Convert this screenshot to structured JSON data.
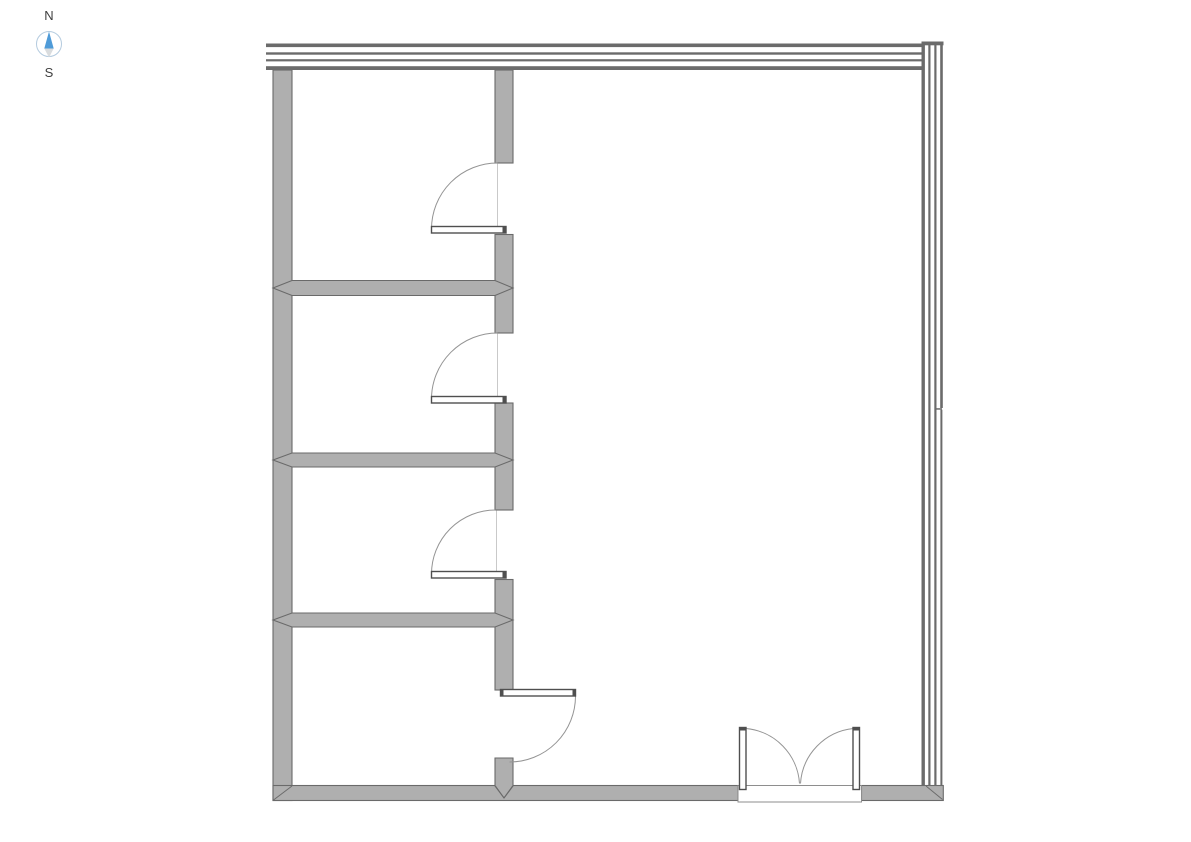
{
  "compass": {
    "north_label": "N",
    "south_label": "S",
    "ring_color": "#b4cbdf",
    "north_needle_color": "#4f9bd8",
    "south_needle_color": "#d9dcde",
    "label_color": "#3f3f3f"
  },
  "colors": {
    "background": "#ffffff",
    "wall_fill": "#afafaf",
    "wall_outline": "#6a6a6a",
    "curtain_line": "#6b6b6b",
    "door_swing": "#949494",
    "door_leaf_outline": "#4f4f4f"
  },
  "plan": {
    "canvas_width": 1191,
    "canvas_height": 842,
    "elements": [
      {
        "kind": "rect",
        "name": "left-exterior-wall",
        "cls": "wall",
        "interactable": true,
        "attrs": {
          "x": 273,
          "y": 70,
          "width": 19,
          "height": 730.5
        }
      },
      {
        "kind": "rect",
        "name": "south-wall-west-segment",
        "cls": "wall",
        "interactable": true,
        "attrs": {
          "x": 273,
          "y": 785.5,
          "width": 465,
          "height": 15
        }
      },
      {
        "kind": "rect",
        "name": "south-wall-east-segment",
        "cls": "wall",
        "interactable": true,
        "attrs": {
          "x": 861.5,
          "y": 785.5,
          "width": 81.8,
          "height": 15
        }
      },
      {
        "kind": "rect",
        "name": "interior-wall-segment-1",
        "cls": "wall",
        "interactable": true,
        "attrs": {
          "x": 495,
          "y": 70,
          "width": 18,
          "height": 93
        }
      },
      {
        "kind": "rect",
        "name": "interior-wall-segment-2",
        "cls": "wall",
        "interactable": true,
        "attrs": {
          "x": 495,
          "y": 234.5,
          "width": 18,
          "height": 98.5
        }
      },
      {
        "kind": "rect",
        "name": "interior-wall-segment-3",
        "cls": "wall",
        "interactable": true,
        "attrs": {
          "x": 495,
          "y": 403,
          "width": 18,
          "height": 107
        }
      },
      {
        "kind": "rect",
        "name": "interior-wall-segment-4",
        "cls": "wall",
        "interactable": true,
        "attrs": {
          "x": 495,
          "y": 579.5,
          "width": 18,
          "height": 110.5
        }
      },
      {
        "kind": "polygon",
        "name": "interior-wall-segment-5",
        "cls": "wall",
        "interactable": true,
        "attrs": {
          "points": "495,758 513,758 513,786 504,798 495,786"
        }
      },
      {
        "kind": "polygon",
        "name": "partition-wall-1",
        "cls": "wall",
        "interactable": true,
        "attrs": {
          "points": "273,288 292,280.5 495,280.5 513,288 495,295.5 292,295.5"
        }
      },
      {
        "kind": "polygon",
        "name": "partition-wall-2",
        "cls": "wall",
        "interactable": true,
        "attrs": {
          "points": "273,460 292,453 495,453 513,460 495,467 292,467"
        }
      },
      {
        "kind": "polygon",
        "name": "partition-wall-3",
        "cls": "wall",
        "interactable": true,
        "attrs": {
          "points": "273,620 292,613 495,613 513,620 495,627 292,627"
        }
      },
      {
        "kind": "line",
        "name": "southwest-corner-miter-seam",
        "cls": "seam",
        "interactable": false,
        "attrs": {
          "x1": 273.5,
          "y1": 800,
          "x2": 292,
          "y2": 786
        }
      },
      {
        "kind": "line",
        "name": "interior-wall-south-miter-seam-left",
        "cls": "seam",
        "interactable": false,
        "attrs": {
          "x1": 495.5,
          "y1": 786,
          "x2": 504,
          "y2": 798
        }
      },
      {
        "kind": "line",
        "name": "interior-wall-south-miter-seam-right",
        "cls": "seam",
        "interactable": false,
        "attrs": {
          "x1": 504,
          "y1": 798,
          "x2": 512.5,
          "y2": 786
        }
      },
      {
        "kind": "line",
        "name": "southeast-corner-miter-seam",
        "cls": "seam",
        "interactable": false,
        "attrs": {
          "x1": 926,
          "y1": 786,
          "x2": 942.5,
          "y2": 799.5
        }
      },
      {
        "kind": "rect",
        "name": "north-curtain-wall-line-1",
        "cls": "cline",
        "interactable": true,
        "attrs": {
          "x": 266,
          "y": 43.5,
          "width": 656,
          "height": 3.6
        }
      },
      {
        "kind": "rect",
        "name": "north-curtain-wall-line-2",
        "cls": "cline",
        "interactable": true,
        "attrs": {
          "x": 266,
          "y": 52.3,
          "width": 656,
          "height": 2.4
        }
      },
      {
        "kind": "rect",
        "name": "north-curtain-wall-line-3",
        "cls": "cline",
        "interactable": true,
        "attrs": {
          "x": 266,
          "y": 59.2,
          "width": 656,
          "height": 2.2
        }
      },
      {
        "kind": "rect",
        "name": "north-curtain-wall-line-4",
        "cls": "cline",
        "interactable": true,
        "attrs": {
          "x": 266,
          "y": 66.2,
          "width": 656,
          "height": 3.8
        }
      },
      {
        "kind": "rect",
        "name": "east-curtain-wall-top-cap",
        "cls": "cline",
        "interactable": true,
        "attrs": {
          "x": 921.5,
          "y": 41.5,
          "width": 22,
          "height": 3.8
        }
      },
      {
        "kind": "rect",
        "name": "east-curtain-wall-line-1",
        "cls": "cline",
        "interactable": true,
        "attrs": {
          "x": 921.5,
          "y": 41.5,
          "width": 3.4,
          "height": 744
        }
      },
      {
        "kind": "rect",
        "name": "east-curtain-wall-line-2",
        "cls": "cline",
        "interactable": true,
        "attrs": {
          "x": 928.3,
          "y": 45,
          "width": 2.2,
          "height": 740.5
        }
      },
      {
        "kind": "rect",
        "name": "east-curtain-wall-line-3",
        "cls": "cline",
        "interactable": true,
        "attrs": {
          "x": 934.3,
          "y": 45,
          "width": 2.2,
          "height": 740.5
        }
      },
      {
        "kind": "rect",
        "name": "east-curtain-wall-line-4-upper",
        "cls": "cline",
        "interactable": true,
        "attrs": {
          "x": 940.2,
          "y": 45,
          "width": 2.6,
          "height": 363
        }
      },
      {
        "kind": "rect",
        "name": "east-curtain-wall-panel-break",
        "cls": "cline",
        "interactable": false,
        "attrs": {
          "x": 936,
          "y": 408.2,
          "width": 6,
          "height": 1.5
        }
      },
      {
        "kind": "rect",
        "name": "east-curtain-wall-line-4-lower",
        "cls": "cline",
        "interactable": true,
        "attrs": {
          "x": 940.4,
          "y": 409.7,
          "width": 2,
          "height": 375.8
        }
      },
      {
        "kind": "line",
        "name": "door-1-frame-line",
        "cls": "frame",
        "interactable": false,
        "attrs": {
          "x1": 497.5,
          "y1": 163.5,
          "x2": 497.5,
          "y2": 226
        }
      },
      {
        "kind": "path",
        "name": "door-1-swing-arc",
        "cls": "arc",
        "interactable": true,
        "attrs": {
          "d": "M431.5,229 A66,66 0 0 1 497.5,163"
        }
      },
      {
        "kind": "rect",
        "name": "door-1-leaf",
        "cls": "leaf",
        "interactable": true,
        "attrs": {
          "x": 431.5,
          "y": 226.5,
          "width": 74.5,
          "height": 6.5
        }
      },
      {
        "kind": "rect",
        "name": "door-1-hinge-cap",
        "cls": "cap",
        "interactable": false,
        "attrs": {
          "x": 502.5,
          "y": 226.5,
          "width": 3.5,
          "height": 6.5
        }
      },
      {
        "kind": "line",
        "name": "door-2-frame-line",
        "cls": "frame",
        "interactable": false,
        "attrs": {
          "x1": 497.5,
          "y1": 333.5,
          "x2": 497.5,
          "y2": 396
        }
      },
      {
        "kind": "path",
        "name": "door-2-swing-arc",
        "cls": "arc",
        "interactable": true,
        "attrs": {
          "d": "M431.5,399 A66,66 0 0 1 497.5,333"
        }
      },
      {
        "kind": "rect",
        "name": "door-2-leaf",
        "cls": "leaf",
        "interactable": true,
        "attrs": {
          "x": 431.5,
          "y": 396.5,
          "width": 74.5,
          "height": 6.5
        }
      },
      {
        "kind": "rect",
        "name": "door-2-hinge-cap",
        "cls": "cap",
        "interactable": false,
        "attrs": {
          "x": 502.5,
          "y": 396.5,
          "width": 3.5,
          "height": 6.5
        }
      },
      {
        "kind": "line",
        "name": "door-3-frame-line",
        "cls": "frame",
        "interactable": false,
        "attrs": {
          "x1": 496.5,
          "y1": 510.5,
          "x2": 496.5,
          "y2": 571.5
        }
      },
      {
        "kind": "path",
        "name": "door-3-swing-arc",
        "cls": "arc",
        "interactable": true,
        "attrs": {
          "d": "M431.5,574 A64,64 0 0 1 495.5,510"
        }
      },
      {
        "kind": "rect",
        "name": "door-3-leaf",
        "cls": "leaf",
        "interactable": true,
        "attrs": {
          "x": 431.5,
          "y": 571.5,
          "width": 74.5,
          "height": 6.5
        }
      },
      {
        "kind": "rect",
        "name": "door-3-hinge-cap",
        "cls": "cap",
        "interactable": false,
        "attrs": {
          "x": 502.5,
          "y": 571.5,
          "width": 3.5,
          "height": 6.5
        }
      },
      {
        "kind": "path",
        "name": "door-4-swing-arc",
        "cls": "arc",
        "interactable": true,
        "attrs": {
          "d": "M575.5,696 A66,66 0 0 1 509.5,762"
        }
      },
      {
        "kind": "rect",
        "name": "door-4-leaf",
        "cls": "leaf",
        "interactable": true,
        "attrs": {
          "x": 500.5,
          "y": 689.5,
          "width": 75,
          "height": 6.5
        }
      },
      {
        "kind": "rect",
        "name": "door-4-hinge-cap",
        "cls": "cap",
        "interactable": false,
        "attrs": {
          "x": 500.5,
          "y": 689.5,
          "width": 3,
          "height": 6.5
        }
      },
      {
        "kind": "rect",
        "name": "door-4-latch-cap",
        "cls": "cap",
        "interactable": false,
        "attrs": {
          "x": 572.5,
          "y": 689.5,
          "width": 3,
          "height": 6.5
        }
      },
      {
        "kind": "rect",
        "name": "double-door-threshold",
        "cls": "threshold",
        "interactable": true,
        "attrs": {
          "x": 738,
          "y": 785.5,
          "width": 123.5,
          "height": 16.5
        }
      },
      {
        "kind": "path",
        "name": "double-door-left-swing-arc",
        "cls": "arc",
        "interactable": true,
        "attrs": {
          "d": "M746,728.5 A59,59 0 0 1 799.5,783.5"
        }
      },
      {
        "kind": "path",
        "name": "double-door-right-swing-arc",
        "cls": "arc",
        "interactable": true,
        "attrs": {
          "d": "M853.5,728.5 A59,59 0 0 0 800.5,783.5"
        }
      },
      {
        "kind": "rect",
        "name": "double-door-left-leaf",
        "cls": "leaf",
        "interactable": true,
        "attrs": {
          "x": 739.5,
          "y": 727.5,
          "width": 6.5,
          "height": 62
        }
      },
      {
        "kind": "rect",
        "name": "double-door-right-leaf",
        "cls": "leaf",
        "interactable": true,
        "attrs": {
          "x": 853,
          "y": 727.5,
          "width": 6.5,
          "height": 62
        }
      },
      {
        "kind": "rect",
        "name": "double-door-left-leaf-cap",
        "cls": "cap",
        "interactable": false,
        "attrs": {
          "x": 739.5,
          "y": 727.5,
          "width": 6.5,
          "height": 3
        }
      },
      {
        "kind": "rect",
        "name": "double-door-right-leaf-cap",
        "cls": "cap",
        "interactable": false,
        "attrs": {
          "x": 853,
          "y": 727.5,
          "width": 6.5,
          "height": 3
        }
      }
    ]
  }
}
